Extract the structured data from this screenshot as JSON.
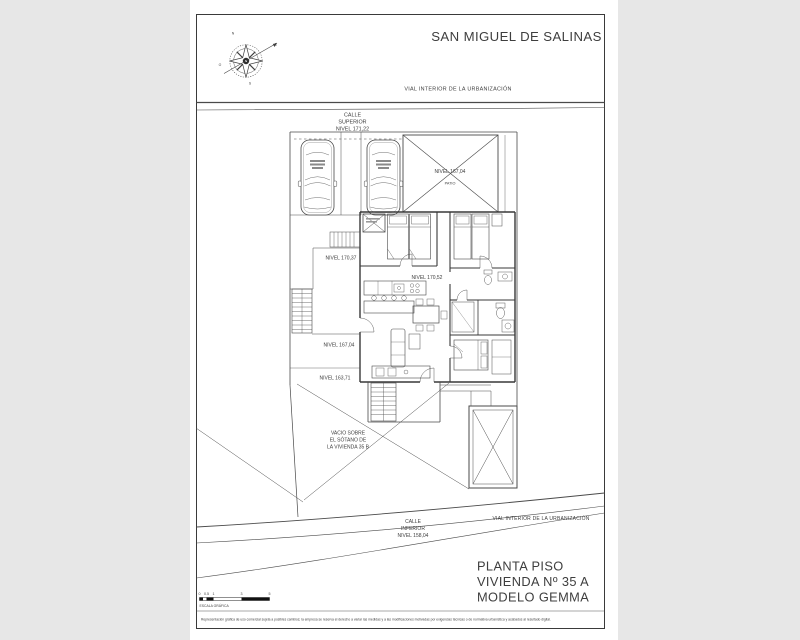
{
  "sheet": {
    "municipality": "SAN MIGUEL DE SALINAS",
    "road_top": "VIAL INTERIOR DE LA URBANIZACIÓN",
    "road_bottom": "VIAL INTERIOR DE LA URBANIZACIÓN",
    "title_block": {
      "line1": "PLANTA PISO",
      "line2": "VIVIENDA Nº 35 A",
      "line3": "MODELO GEMMA"
    },
    "disclaimer": "Representación gráfica de uso comercial sujeta a posibles cambios; la empresa se reserva el derecho a variar las medidas y a las modificaciones motivadas por exigencias técnicas o de normativa urbanística y acabados al resultado digital."
  },
  "streets": {
    "calle_superior": {
      "line1": "CALLE",
      "line2": "SUPERIOR",
      "line3": "NIVEL 171,22"
    },
    "calle_inferior": {
      "line1": "CALLE",
      "line2": "INFERIOR",
      "line3": "NIVEL 158,04"
    }
  },
  "levels": {
    "garage_roof": "NIVEL 167,04",
    "garage_roof_sub": "PATIO",
    "terrace_mid": "NIVEL 170,37",
    "interior": "NIVEL 170,52",
    "terrace_low": "NIVEL 167,04",
    "terrace_lowest": "NIVEL 163,71"
  },
  "void_note": {
    "line1": "VACIO SOBRE",
    "line2": "EL SÓTANO DE",
    "line3": "LA VIVIENDA 35 B"
  },
  "compass": {
    "n": "N",
    "s": "S",
    "e": "E",
    "o": "O"
  },
  "scale_bar": {
    "t0": "0",
    "t05": "0.5",
    "t1": "1",
    "t3": "3",
    "t5": "5",
    "caption": "ESCALA GRÁFICA"
  },
  "colors": {
    "ink": "#4a4a4a",
    "paper": "#ffffff",
    "margin": "#e7e7e7"
  }
}
